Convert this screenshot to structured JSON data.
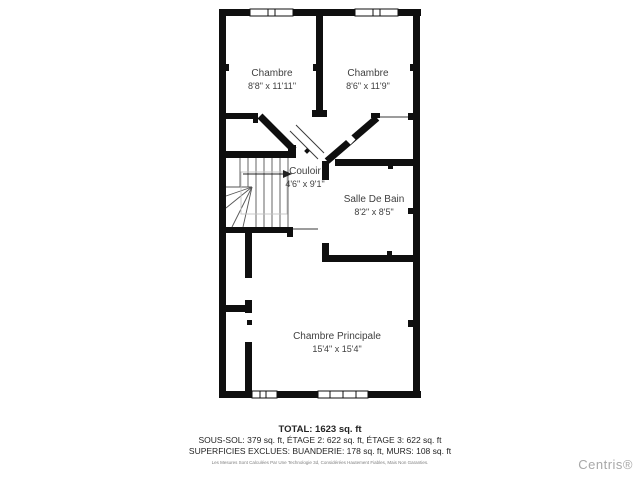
{
  "plan": {
    "rooms": [
      {
        "id": "chambre-left",
        "name": "Chambre",
        "dims": "8'8\" x 11'11\""
      },
      {
        "id": "chambre-right",
        "name": "Chambre",
        "dims": "8'6\" x 11'9\""
      },
      {
        "id": "couloir",
        "name": "Couloir",
        "dims": "4'6\" x 9'1\""
      },
      {
        "id": "salle-de-bain",
        "name": "Salle De Bain",
        "dims": "8'2\" x 8'5\""
      },
      {
        "id": "chambre-principale",
        "name": "Chambre Principale",
        "dims": "15'4\" x 15'4\""
      }
    ]
  },
  "summary": {
    "total": "TOTAL: 1623 sq. ft",
    "floors": "SOUS-SOL: 379 sq. ft, ÉTAGE 2: 622 sq. ft, ÉTAGE 3: 622 sq. ft",
    "exclusions": "SUPERFICIES EXCLUES: BUANDERIE: 178 sq. ft, MURS: 108 sq. ft",
    "disclaimer": "Les Mesures Sont Calculées Par Une Technologie 3d, Considérées Hautement Fiables, Mais Non Garanties."
  },
  "watermark": "Centris®",
  "colors": {
    "wall": "#0f0f0f",
    "room_text": "#3f3f3f",
    "watermark_text": "#a8a8a8"
  }
}
